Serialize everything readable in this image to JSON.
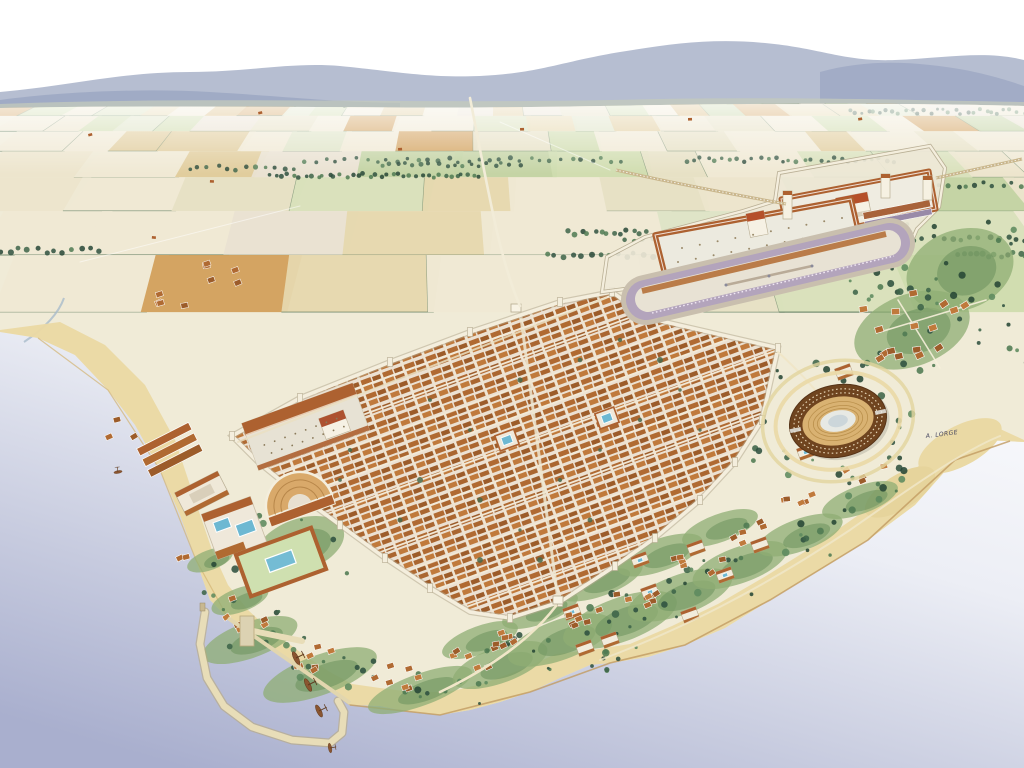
{
  "scene": {
    "title": "Bird's-eye watercolour reconstruction of an ancient Roman coastal city",
    "signature": "A. LORGE",
    "landmarks": [
      {
        "id": "walled-city",
        "label": "walled lower town with orthogonal street grid"
      },
      {
        "id": "colonial-forum",
        "label": "forum with basilica and temple"
      },
      {
        "id": "provincial-forum",
        "label": "upper porticoed forum terrace"
      },
      {
        "id": "temple-precinct",
        "label": "imperial cult temple precinct"
      },
      {
        "id": "circus",
        "label": "circus with curved western end"
      },
      {
        "id": "amphitheatre",
        "label": "amphitheatre in gardens outside the walls"
      },
      {
        "id": "theatre",
        "label": "theatre with portico garden and pool"
      },
      {
        "id": "baths",
        "label": "bath complex with blue pools"
      },
      {
        "id": "harbour",
        "label": "harbour with breakwater, T-pier and moored ships"
      },
      {
        "id": "warehouses",
        "label": "shoreline warehouses"
      },
      {
        "id": "aqueduct",
        "label": "aqueduct entering the upper terrace"
      },
      {
        "id": "suburban-villas",
        "label": "suburban villas and gardens along the shore"
      },
      {
        "id": "village",
        "label": "roadside village east of the city"
      },
      {
        "id": "farmland",
        "label": "patchwork farmland plain with hedgerows"
      },
      {
        "id": "mountains",
        "label": "blue mountain ridge on the horizon"
      },
      {
        "id": "sea",
        "label": "pale lavender sea"
      }
    ]
  },
  "palette": {
    "sky": "#ffffff",
    "mountain": "#aeb7cc",
    "mountain_near": "#9ba6c2",
    "foothill": "#c3cabb",
    "sea_deep": "#a9afce",
    "sea_mid": "#c9cde0",
    "sea_light": "#eceef5",
    "land_base": "#f0ebd7",
    "sand": "#ead9a4",
    "cliff": "#c29b62",
    "roof": "#b06a32",
    "roof_dark": "#9c5c2a",
    "roof_light": "#c07a3c",
    "roof_pale": "#ad6130",
    "wall_light": "#f4eedd",
    "wall_shadow": "#b5aa90",
    "plaza": "#eceadf",
    "monument_roof": "#b5502a",
    "pool_water": "#6db8d2",
    "tree_dark": "#2f5140",
    "tree_mid": "#4f7a52",
    "scrub": "#8fae74",
    "arena_facade": "#6f441f",
    "cavea": "#d9b272",
    "track": "#e8e2d4",
    "circus_seats": "#b3a4bc",
    "field_cream": "#efe9d4",
    "field_green": "#c2d3a2",
    "field_ochre": "#d2a05c",
    "hedge": "#5c7a5e",
    "road": "#f2ecd8",
    "ship_hull": "#8a5530",
    "stream": "#a9bccb",
    "signature_ink": "#44445e"
  }
}
